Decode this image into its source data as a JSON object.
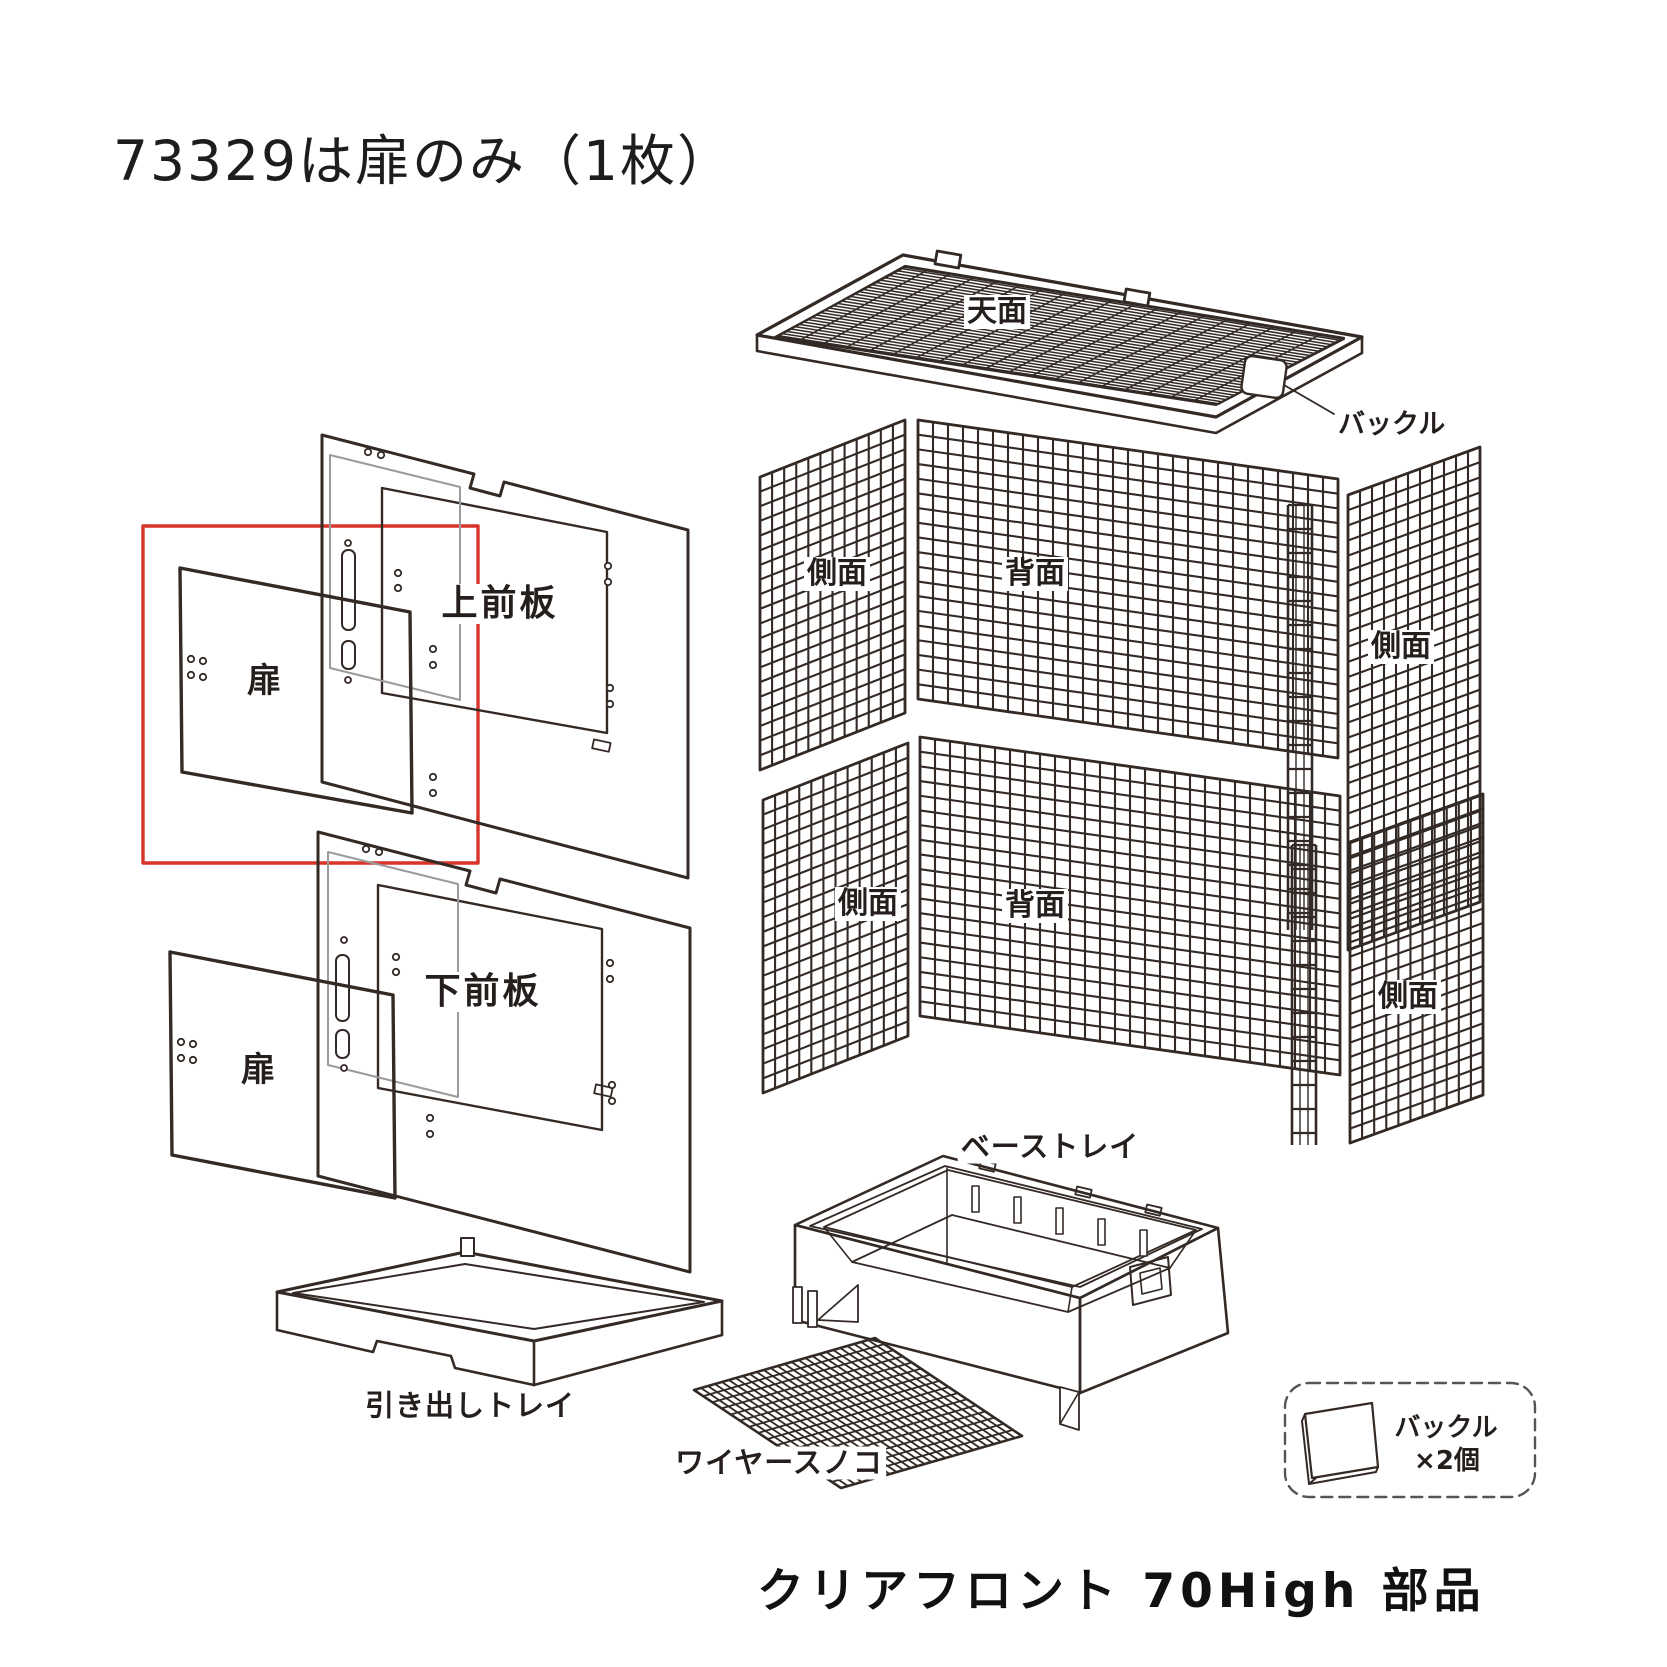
{
  "page": {
    "title_note": "73329は扉のみ（1枚）",
    "product_title": "クリアフロント 70High 部品"
  },
  "colors": {
    "line": "#332a26",
    "accent_red": "#d9342b",
    "acrylic_gray": "#9b9b9b"
  },
  "parts": {
    "top_panel": "天面",
    "buckle_callout": "バックル",
    "upper_side_left": "側面",
    "upper_back": "背面",
    "upper_side_right": "側面",
    "lower_side_left": "側面",
    "lower_back": "背面",
    "lower_side_right": "側面",
    "upper_front_plate": "上前板",
    "upper_door": "扉",
    "lower_front_plate": "下前板",
    "lower_door": "扉",
    "drawer_tray": "引き出しトレイ",
    "wire_grate": "ワイヤースノコ",
    "base_tray": "ベーストレイ",
    "buckle_legend_name": "バックル",
    "buckle_legend_qty": "×2個"
  }
}
